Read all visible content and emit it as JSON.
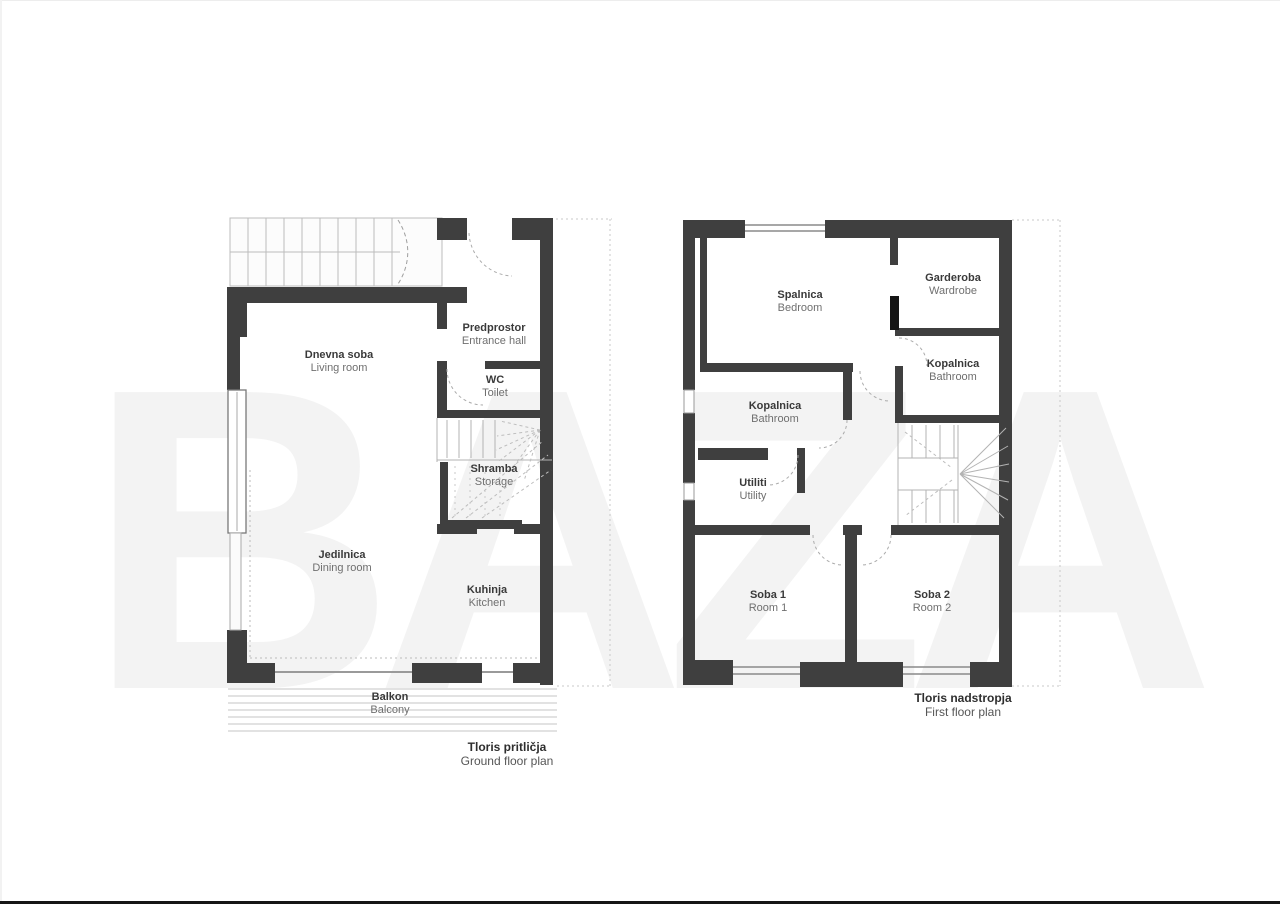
{
  "watermark": "BAZA",
  "colors": {
    "wall": "#3f3f3f",
    "thin_line": "#b3b3b3",
    "label_text": "#3a3a3a",
    "secondary_text": "#6f6f6f",
    "watermark": "#f3f3f3"
  },
  "ground_floor": {
    "caption_sl": "Tloris pritličja",
    "caption_en": "Ground floor plan",
    "rooms": [
      {
        "id": "living",
        "sl": "Dnevna soba",
        "en": "Living room"
      },
      {
        "id": "entrance",
        "sl": "Predprostor",
        "en": "Entrance hall"
      },
      {
        "id": "wc",
        "sl": "WC",
        "en": "Toilet"
      },
      {
        "id": "storage",
        "sl": "Shramba",
        "en": "Storage"
      },
      {
        "id": "dining",
        "sl": "Jedilnica",
        "en": "Dining room"
      },
      {
        "id": "kitchen",
        "sl": "Kuhinja",
        "en": "Kitchen"
      },
      {
        "id": "balcony",
        "sl": "Balkon",
        "en": "Balcony"
      }
    ]
  },
  "first_floor": {
    "caption_sl": "Tloris nadstropja",
    "caption_en": "First floor plan",
    "rooms": [
      {
        "id": "bedroom",
        "sl": "Spalnica",
        "en": "Bedroom"
      },
      {
        "id": "wardrobe",
        "sl": "Garderoba",
        "en": "Wardrobe"
      },
      {
        "id": "bathroom-right",
        "sl": "Kopalnica",
        "en": "Bathroom"
      },
      {
        "id": "bathroom-left",
        "sl": "Kopalnica",
        "en": "Bathroom"
      },
      {
        "id": "utility",
        "sl": "Utiliti",
        "en": "Utility"
      },
      {
        "id": "room1",
        "sl": "Soba 1",
        "en": "Room 1"
      },
      {
        "id": "room2",
        "sl": "Soba 2",
        "en": "Room 2"
      }
    ]
  }
}
